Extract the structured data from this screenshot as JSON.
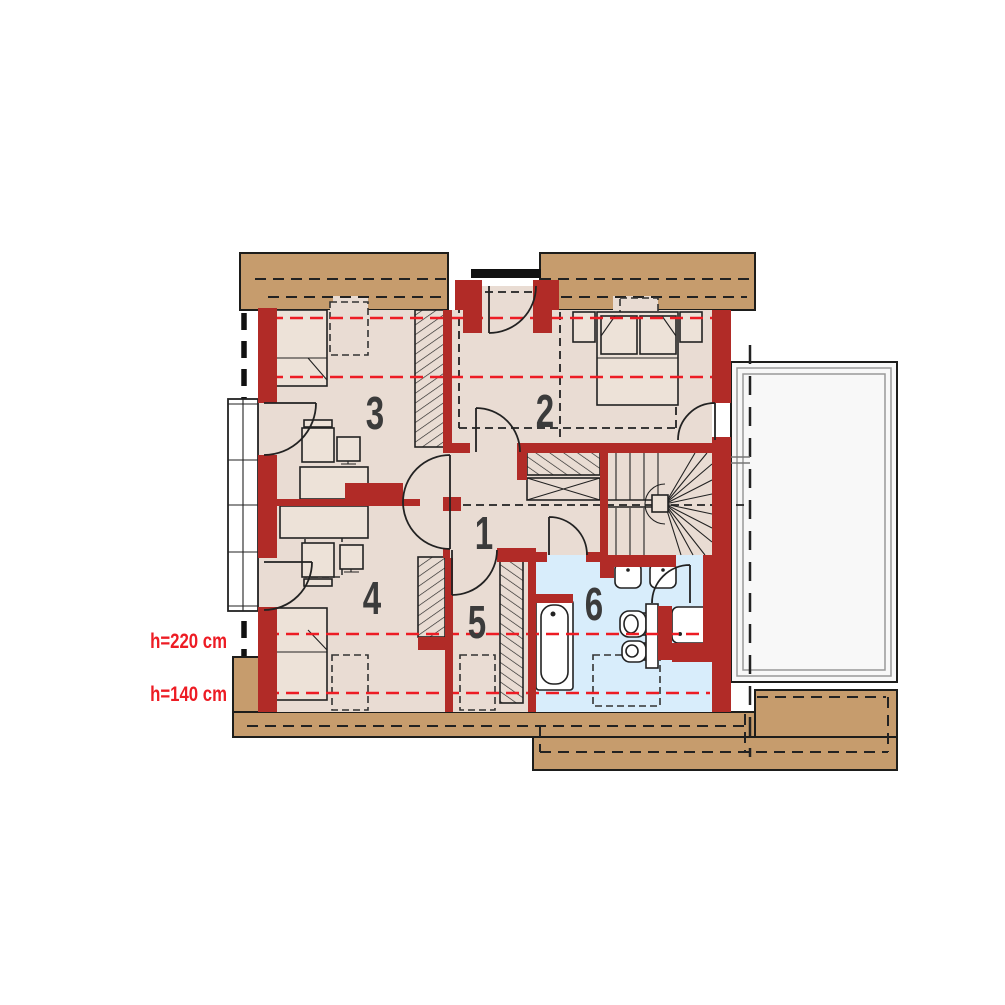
{
  "title": "attic floor plan",
  "rooms": [
    {
      "number": "1"
    },
    {
      "number": "2"
    },
    {
      "number": "3"
    },
    {
      "number": "4"
    },
    {
      "number": "5"
    },
    {
      "number": "6"
    }
  ],
  "height_labels": [
    {
      "text": "h=220 cm"
    },
    {
      "text": "h=140 cm"
    }
  ],
  "colors": {
    "wall_red": "#B12B27",
    "floor_beige": "#E9DCD3",
    "bathroom_blue": "#D8EDFB",
    "eaves_tan": "#C69C6D",
    "terrace_white": "#F8F8F8",
    "height_line_red": "#ED1C24",
    "outline": "#1D1D1B"
  }
}
